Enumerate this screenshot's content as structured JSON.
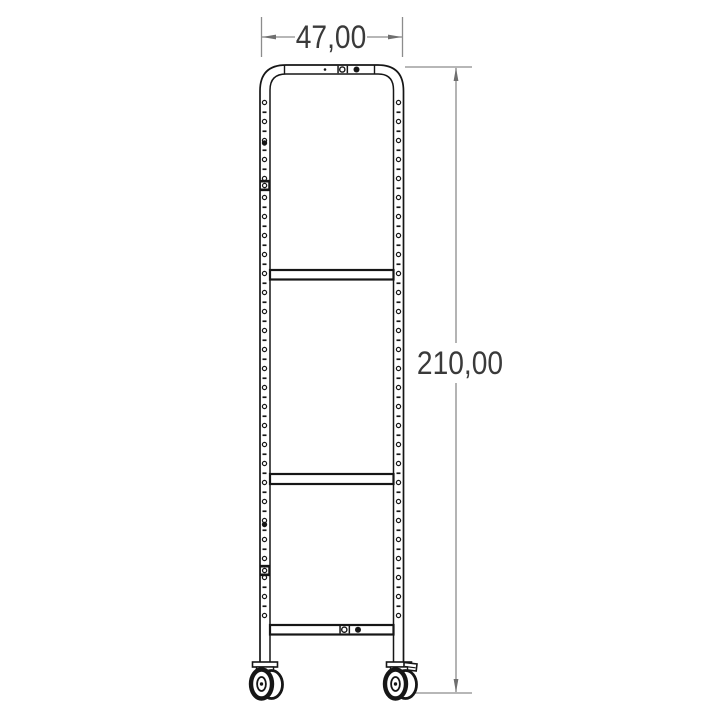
{
  "drawing": {
    "kind": "technical-drawing-front-view",
    "subject": "upright tube frame with three crossbars and two swivel casters",
    "dimensions": {
      "width_label": "47,00",
      "height_label": "210,00"
    },
    "colors": {
      "background": "#ffffff",
      "frame_line": "#161616",
      "dimension_line": "#8c8c8c",
      "dimension_arrow": "#6f6f6f",
      "dimension_text": "#3a3a3a"
    }
  }
}
